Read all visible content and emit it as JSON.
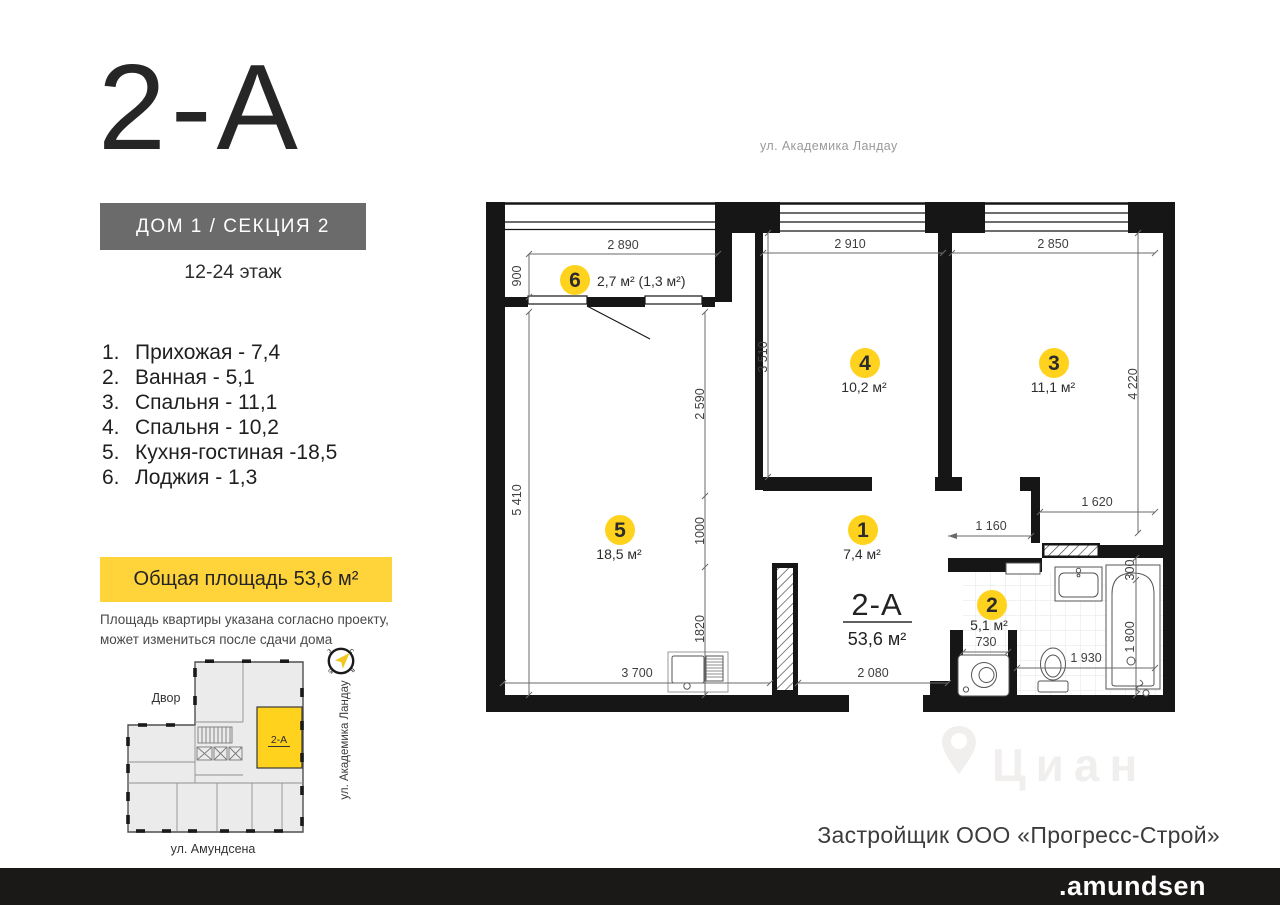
{
  "header": {
    "apartment_title": "2-А",
    "building": "ДОМ 1 / СЕКЦИЯ 2",
    "floors": "12-24 этаж"
  },
  "room_list": [
    {
      "n": "1.",
      "label": "Прихожая - 7,4"
    },
    {
      "n": "2.",
      "label": "Ванная - 5,1"
    },
    {
      "n": "3.",
      "label": "Спальня - 11,1"
    },
    {
      "n": "4.",
      "label": "Спальня - 10,2"
    },
    {
      "n": "5.",
      "label": "Кухня-гостиная -18,5"
    },
    {
      "n": "6.",
      "label": "Лоджия - 1,3"
    }
  ],
  "total_area_label": "Общая площадь 53,6 м²",
  "note_line1": "Площадь квартиры указана согласно проекту,",
  "note_line2": "может измениться после сдачи дома",
  "mini_plan": {
    "unit": "2-А",
    "yard": "Двор",
    "street_bottom": "ул. Амундсена",
    "street_right": "ул. Академика Ландау",
    "compass": {
      "n": "с",
      "e": "в",
      "s": "ю",
      "w": "з"
    }
  },
  "plan": {
    "street_top": "ул. Академика Ландау",
    "apartment": "2-А",
    "apartment_area": "53,6 м²",
    "badges": {
      "b1": {
        "n": "1",
        "area": "7,4 м²"
      },
      "b2": {
        "n": "2",
        "area": "5,1 м²"
      },
      "b3": {
        "n": "3",
        "area": "11,1 м²"
      },
      "b4": {
        "n": "4",
        "area": "10,2 м²"
      },
      "b5": {
        "n": "5",
        "area": "18,5 м²"
      },
      "b6": {
        "n": "6",
        "area": "2,7 м² (1,3 м²)"
      }
    },
    "dims": {
      "d2890": "2 890",
      "d2910": "2 910",
      "d2850": "2 850",
      "d900": "900",
      "d5410": "5 410",
      "d3510": "3 510",
      "d4220": "4 220",
      "d2590": "2 590",
      "d1000": "1000",
      "d1820": "1820",
      "d3700": "3 700",
      "d2080": "2 080",
      "d1160": "1 160",
      "d1620": "1 620",
      "d730": "730",
      "d1930": "1 930",
      "d300": "300",
      "d1800": "1 800"
    }
  },
  "developer": "Застройщик ООО «Прогресс-Строй»",
  "watermark": "Циан",
  "footer_brand": ".amundsen",
  "colors": {
    "accent_yellow": "#FFD21E",
    "box_yellow": "#FFD43B",
    "label_gray": "#6B6B6B",
    "wall": "#161616",
    "footer_bg": "#1B1918"
  }
}
